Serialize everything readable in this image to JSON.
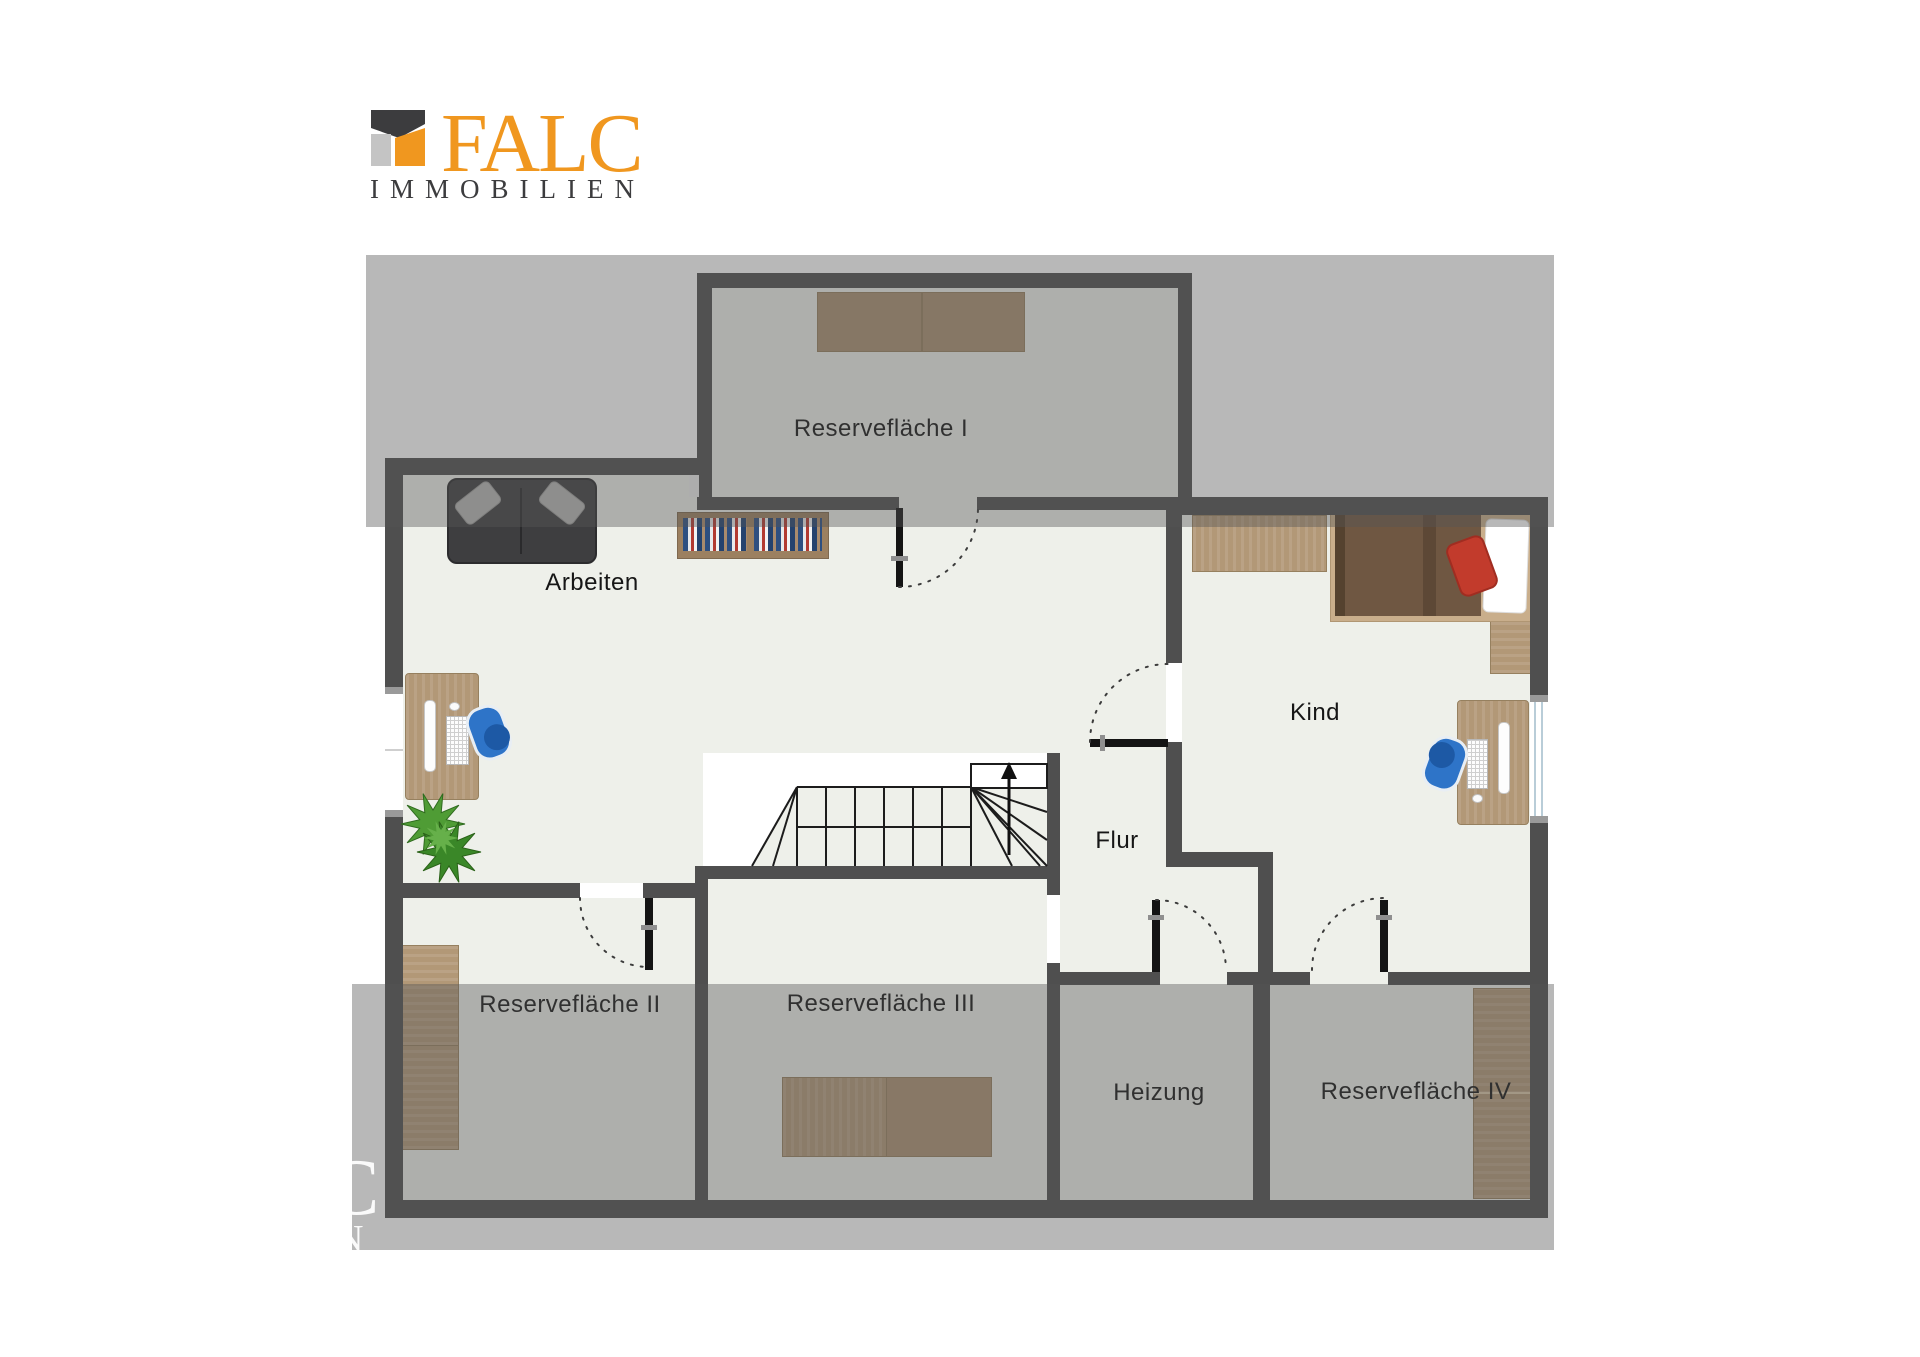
{
  "logo": {
    "brand": "FALC",
    "subtitle": "IMMOBILIEN",
    "colors": {
      "orange": "#f0971f",
      "dark": "#3c3c3e",
      "gray": "#c4c4c4"
    }
  },
  "floorplan": {
    "rooms": [
      {
        "id": "reserveflaeche-1",
        "label": "Reservefläche I"
      },
      {
        "id": "arbeiten",
        "label": "Arbeiten"
      },
      {
        "id": "kind",
        "label": "Kind"
      },
      {
        "id": "flur",
        "label": "Flur"
      },
      {
        "id": "reserveflaeche-2",
        "label": "Reservefläche II"
      },
      {
        "id": "reserveflaeche-3",
        "label": "Reservefläche III"
      },
      {
        "id": "heizung",
        "label": "Heizung"
      },
      {
        "id": "reserveflaeche-4",
        "label": "Reservefläche IV"
      }
    ],
    "stairs": {
      "direction_arrow": "up"
    },
    "colors": {
      "wall": "#4f4f4f",
      "floor": "#eef0ea",
      "sloped_area_overlay": "rgba(85,85,85,0.42)",
      "door_leaf": "#141414",
      "chair_blue": "#2e74c8",
      "plant_green": "#4f9c35",
      "bed_red_cushion": "#c23b2c"
    }
  },
  "watermark": {
    "letters": [
      "C",
      "N"
    ]
  }
}
